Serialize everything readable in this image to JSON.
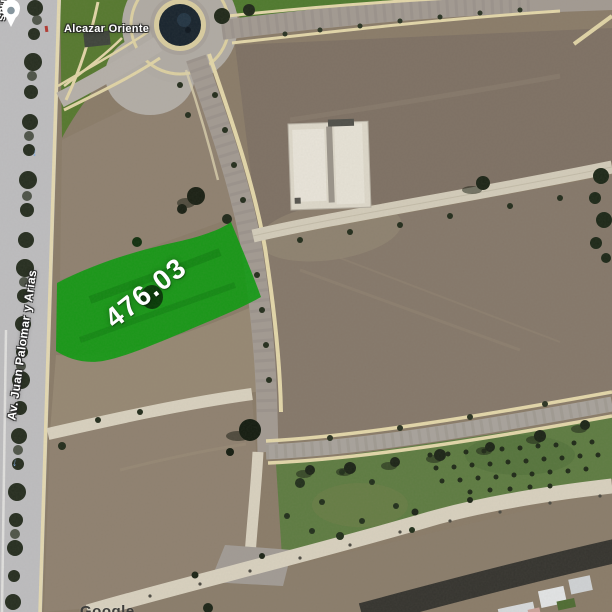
{
  "map": {
    "labels": {
      "place": "Alcazar Oriente",
      "street": "Av. Juan Palomar y Arias",
      "street_fragment": "Arias",
      "watermark": "Google"
    },
    "parcel_overlay": {
      "area_value": "476.03",
      "fill_color": "#0c9a10"
    },
    "icons": {
      "one_way_arrow": "↑"
    },
    "colors": {
      "pond": "#18242e",
      "paved_road": "#a29a92",
      "concrete_road": "#d8d1bf",
      "sidewalk": "#e3d7aa",
      "dirt": "#8a7c69",
      "grass": "#567c31",
      "label_text": "#ffffff"
    }
  }
}
